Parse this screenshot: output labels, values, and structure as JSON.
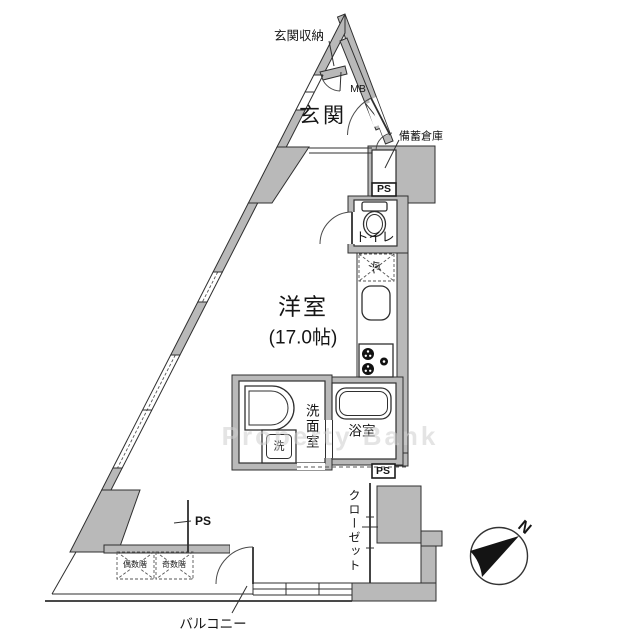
{
  "floorplan": {
    "labels": {
      "entrance_storage": "玄関収納",
      "meter_box": "MB",
      "entrance": "玄関",
      "emergency_storage": "備蓄倉庫",
      "ps_top": "PS",
      "toilet": "トイレ",
      "refrigerator": "冷",
      "main_room_name": "洋室",
      "main_room_size": "(17.0帖)",
      "washroom": "洗面室",
      "bathroom": "浴室",
      "washer": "洗",
      "ps_right": "PS",
      "closet": "クローゼット",
      "ps_left": "PS",
      "hatch_even": "偶数階",
      "hatch_odd": "奇数階",
      "balcony": "バルコニー",
      "compass_north": "N"
    },
    "watermark": "Property Bank",
    "colors": {
      "wall_fill": "#b9b9b9",
      "line": "#2f2f2f",
      "background": "#ffffff"
    }
  }
}
